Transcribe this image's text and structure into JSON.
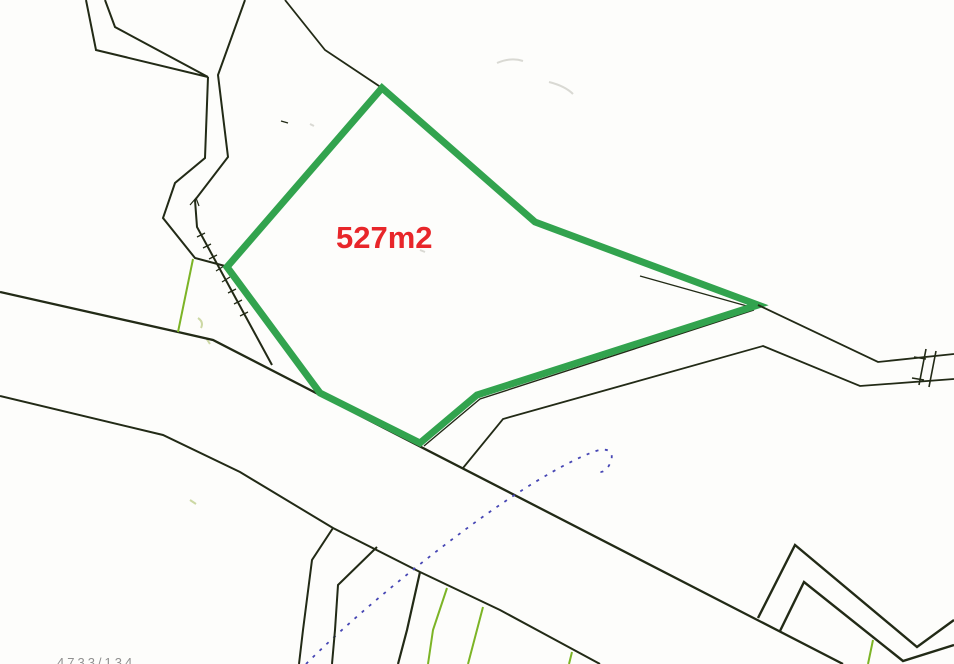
{
  "canvas": {
    "width": 954,
    "height": 664,
    "background": "#fdfdfb"
  },
  "colors": {
    "boundary": "#222a16",
    "parcel_highlight": "#32a34e",
    "field_line": "#7cb426",
    "survey_dashed": "#4646b4",
    "area_text": "#e8262a",
    "faint": "#d9d9d3",
    "faint_olive": "#ccd8a4",
    "muted_text": "#909090"
  },
  "labels": {
    "area": "527m2",
    "parcel_number": "4733/134"
  },
  "map": {
    "features": [
      {
        "name": "scan-smudges",
        "kind": "path",
        "color": "faint",
        "width": 2,
        "d": "M497,63 q14,-6 26,-2 M549,82 q16,4 24,12 M420,250 l5,2 M310,124 l4,2",
        "interactable": false
      },
      {
        "name": "scan-smudge-olive",
        "kind": "path",
        "color": "faint_olive",
        "width": 2,
        "d": "M198,318 q6,4 3,10 M206,338 l4,6 M190,500 l6,4",
        "interactable": false
      },
      {
        "name": "road-upper-edge",
        "kind": "polyline",
        "color": "boundary",
        "width": 2.3,
        "points": [
          [
            0,
            292
          ],
          [
            178,
            332
          ],
          [
            213,
            340
          ],
          [
            843,
            664
          ]
        ],
        "interactable": false
      },
      {
        "name": "road-lower-edge",
        "kind": "polyline",
        "color": "boundary",
        "width": 2,
        "points": [
          [
            0,
            396
          ],
          [
            163,
            435
          ],
          [
            240,
            472
          ],
          [
            333,
            528
          ],
          [
            420,
            572
          ],
          [
            500,
            610
          ],
          [
            600,
            664
          ]
        ],
        "interactable": false
      },
      {
        "name": "track-outer-left-boundary",
        "kind": "polyline",
        "color": "boundary",
        "width": 2,
        "points": [
          [
            86,
            0
          ],
          [
            96,
            50
          ],
          [
            208,
            77
          ]
        ],
        "interactable": false
      },
      {
        "name": "track-inner-left-boundary",
        "kind": "polyline",
        "color": "boundary",
        "width": 2,
        "points": [
          [
            105,
            0
          ],
          [
            115,
            27
          ],
          [
            208,
            77
          ]
        ],
        "interactable": false
      },
      {
        "name": "track-descent-boundary",
        "kind": "polyline",
        "color": "boundary",
        "width": 2,
        "points": [
          [
            208,
            77
          ],
          [
            205,
            158
          ],
          [
            175,
            183
          ],
          [
            163,
            218
          ],
          [
            195,
            258
          ],
          [
            225,
            266
          ]
        ],
        "interactable": false
      },
      {
        "name": "boundary-right-of-track",
        "kind": "polyline",
        "color": "boundary",
        "width": 2,
        "points": [
          [
            245,
            0
          ],
          [
            218,
            75
          ],
          [
            228,
            157
          ],
          [
            195,
            200
          ],
          [
            197,
            227
          ],
          [
            272,
            365
          ]
        ],
        "interactable": false
      },
      {
        "name": "slope-tick-marks",
        "kind": "path",
        "color": "boundary",
        "width": 1.3,
        "d": "M205,233 l-8,4 M211,244 l-8,4 M217,255 l-8,4 M224,266 l-8,5 M230,277 l-8,5 M236,289 l-8,4 M242,300 l-8,4 M248,312 l-8,4",
        "interactable": false
      },
      {
        "name": "bend-tick",
        "kind": "path",
        "color": "boundary",
        "width": 1.2,
        "d": "M190,205 l6,-7 l3,8",
        "interactable": false
      },
      {
        "name": "boundary-into-apex",
        "kind": "polyline",
        "color": "boundary",
        "width": 1.8,
        "points": [
          [
            285,
            0
          ],
          [
            325,
            50
          ],
          [
            382,
            88
          ]
        ],
        "interactable": false
      },
      {
        "name": "small-dash",
        "kind": "path",
        "color": "boundary",
        "width": 1.4,
        "d": "M281,121 l7,2",
        "interactable": false
      },
      {
        "name": "field-line-upper-left",
        "kind": "polyline",
        "color": "field_line",
        "width": 2,
        "points": [
          [
            193,
            259
          ],
          [
            178,
            332
          ]
        ],
        "interactable": false
      },
      {
        "name": "parcel-boundary-underlay-upper",
        "kind": "polyline",
        "color": "boundary",
        "width": 1.4,
        "points": [
          [
            640,
            276
          ],
          [
            754,
            308
          ]
        ],
        "interactable": false
      },
      {
        "name": "parcel-boundary-underlay-lower",
        "kind": "polyline",
        "color": "boundary",
        "width": 1.4,
        "points": [
          [
            754,
            310
          ],
          [
            480,
            399
          ],
          [
            424,
            446
          ]
        ],
        "interactable": false
      },
      {
        "name": "parcel-527-highlight",
        "kind": "polygon",
        "color": "parcel_highlight",
        "width": 7,
        "points": [
          [
            382,
            88
          ],
          [
            535,
            222
          ],
          [
            758,
            305
          ],
          [
            477,
            395
          ],
          [
            420,
            443
          ],
          [
            320,
            393
          ],
          [
            227,
            267
          ]
        ],
        "interactable": true
      },
      {
        "name": "boundary-right-upper",
        "kind": "polyline",
        "color": "boundary",
        "width": 1.8,
        "points": [
          [
            758,
            305
          ],
          [
            878,
            362
          ],
          [
            954,
            354
          ]
        ],
        "interactable": false
      },
      {
        "name": "boundary-right-lower",
        "kind": "polyline",
        "color": "boundary",
        "width": 1.8,
        "points": [
          [
            463,
            468
          ],
          [
            503,
            419
          ],
          [
            763,
            346
          ],
          [
            860,
            386
          ],
          [
            954,
            379
          ]
        ],
        "interactable": false
      },
      {
        "name": "gate-symbol",
        "kind": "path",
        "color": "boundary",
        "width": 1.6,
        "d": "M926,349 l-7,36 M936,351 l-7,36 M914,357 l12,2 M912,378 l12,2",
        "interactable": false
      },
      {
        "name": "survey-dashed-curve",
        "kind": "path",
        "color": "survey_dashed",
        "width": 1.8,
        "dash": "3,6.5",
        "d": "M306,664 C348,622 408,572 462,532 C510,496 564,462 596,451 C608,447 614,452 611,461 C608,470 601,475 597,470",
        "interactable": false
      },
      {
        "name": "branch-boundary-1",
        "kind": "polyline",
        "color": "boundary",
        "width": 2,
        "points": [
          [
            333,
            528
          ],
          [
            312,
            560
          ],
          [
            303,
            630
          ],
          [
            299,
            664
          ]
        ],
        "interactable": false
      },
      {
        "name": "branch-boundary-2",
        "kind": "polyline",
        "color": "boundary",
        "width": 2,
        "points": [
          [
            377,
            547
          ],
          [
            338,
            585
          ],
          [
            335,
            630
          ],
          [
            332,
            664
          ]
        ],
        "interactable": false
      },
      {
        "name": "branch-boundary-3",
        "kind": "polyline",
        "color": "boundary",
        "width": 2.2,
        "points": [
          [
            420,
            572
          ],
          [
            407,
            630
          ],
          [
            398,
            664
          ]
        ],
        "interactable": false
      },
      {
        "name": "field-line-bottom-1",
        "kind": "polyline",
        "color": "field_line",
        "width": 2,
        "points": [
          [
            447,
            588
          ],
          [
            433,
            630
          ],
          [
            428,
            664
          ]
        ],
        "interactable": false
      },
      {
        "name": "field-line-bottom-2",
        "kind": "polyline",
        "color": "field_line",
        "width": 2,
        "points": [
          [
            483,
            607
          ],
          [
            468,
            664
          ]
        ],
        "interactable": false
      },
      {
        "name": "field-line-bottom-3",
        "kind": "polyline",
        "color": "field_line",
        "width": 2,
        "points": [
          [
            572,
            652
          ],
          [
            569,
            664
          ]
        ],
        "interactable": false
      },
      {
        "name": "zigzag-outer-boundary",
        "kind": "polyline",
        "color": "boundary",
        "width": 2.4,
        "points": [
          [
            758,
            618
          ],
          [
            795,
            545
          ],
          [
            917,
            647
          ],
          [
            954,
            620
          ]
        ],
        "interactable": false
      },
      {
        "name": "zigzag-inner-boundary",
        "kind": "polyline",
        "color": "boundary",
        "width": 2.4,
        "points": [
          [
            780,
            631
          ],
          [
            804,
            582
          ],
          [
            903,
            661
          ],
          [
            954,
            645
          ]
        ],
        "interactable": false
      },
      {
        "name": "field-line-bottom-right",
        "kind": "polyline",
        "color": "field_line",
        "width": 2,
        "points": [
          [
            873,
            640
          ],
          [
            868,
            664
          ]
        ],
        "interactable": false
      }
    ]
  }
}
